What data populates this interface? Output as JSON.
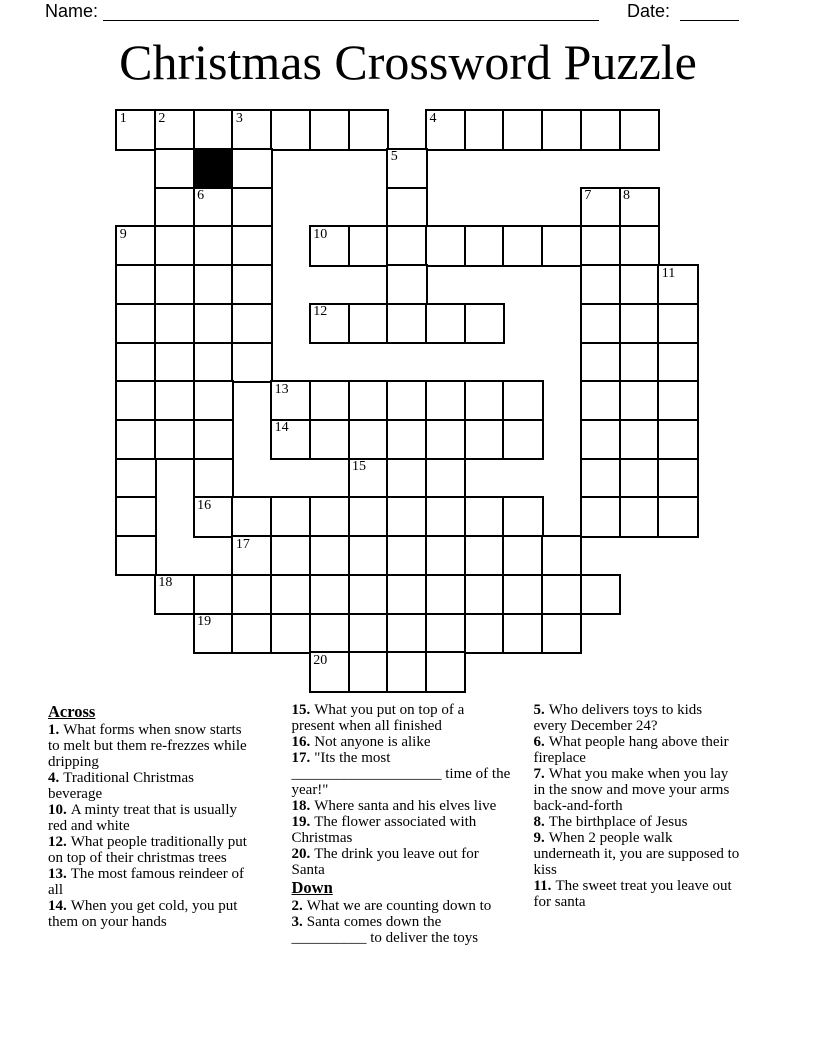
{
  "page": {
    "width": 816,
    "height": 1056,
    "background": "#ffffff"
  },
  "colors": {
    "ink": "#000000",
    "grid_line": "#000000",
    "block_cell": "#000000",
    "paper": "#ffffff"
  },
  "header": {
    "name_label": "Name:",
    "date_label": "Date:"
  },
  "title": "Christmas Crossword Puzzle",
  "grid": {
    "columns": 15,
    "rows": 15,
    "cells": [
      "OOOOOOO.OOOOOO.",
      ".O#O...O.......",
      ".OOO...O....OO.",
      "OOOO.OOOOOOOOO.",
      "OOOO...O....OOO",
      "OOOO.OOOOO..OOO",
      "OOOO........OOO",
      "OOO.OOOOOOO.OOO",
      "OOO.OOOOOOO.OOO",
      "O.O...OOO...OOO",
      "O.OOOOOOOOO.OOO",
      "O..OOOOOOOOO...",
      ".OOOOOOOOOOOO..",
      "..OOOOOOOOOO...",
      ".....OOOO......"
    ],
    "numbers": {
      "0,0": "1",
      "0,1": "2",
      "0,3": "3",
      "0,8": "4",
      "1,7": "5",
      "2,2": "6",
      "2,12": "7",
      "2,13": "8",
      "3,0": "9",
      "3,5": "10",
      "4,14": "11",
      "5,5": "12",
      "7,4": "13",
      "8,4": "14",
      "9,6": "15",
      "10,2": "16",
      "11,3": "17",
      "12,1": "18",
      "13,2": "19",
      "14,5": "20"
    }
  },
  "clues": {
    "columns": [
      {
        "items": [
          {
            "type": "heading",
            "text": "Across"
          },
          {
            "type": "clue",
            "num": "1.",
            "text": "What forms when snow starts\nto melt but them re-frezzes while\ndripping"
          },
          {
            "type": "clue",
            "num": "4.",
            "text": "Traditional Christmas\nbeverage"
          },
          {
            "type": "clue",
            "num": "10.",
            "text": "A minty treat that is usually\nred and white"
          },
          {
            "type": "clue",
            "num": "12.",
            "text": "What people traditionally put\non top of their christmas trees"
          },
          {
            "type": "clue",
            "num": "13.",
            "text": "The most famous reindeer of\nall"
          },
          {
            "type": "clue",
            "num": "14.",
            "text": "When you get cold, you put\nthem on your hands"
          }
        ]
      },
      {
        "items": [
          {
            "type": "clue",
            "num": "15.",
            "text": "What you put on top of a\npresent when all finished"
          },
          {
            "type": "clue",
            "num": "16.",
            "text": "Not anyone is alike"
          },
          {
            "type": "clue",
            "num": "17.",
            "text": "\"Its the most\n____________________ time of the\nyear!\""
          },
          {
            "type": "clue",
            "num": "18.",
            "text": "Where santa and his elves live"
          },
          {
            "type": "clue",
            "num": "19.",
            "text": "The flower associated with\nChristmas"
          },
          {
            "type": "clue",
            "num": "20.",
            "text": "The drink you leave out for\nSanta"
          },
          {
            "type": "heading",
            "text": "Down"
          },
          {
            "type": "clue",
            "num": "2.",
            "text": "What we are counting down to"
          },
          {
            "type": "clue",
            "num": "3.",
            "text": "Santa comes down the\n__________ to deliver the toys"
          }
        ]
      },
      {
        "items": [
          {
            "type": "clue",
            "num": "5.",
            "text": "Who delivers toys to kids\nevery December 24?"
          },
          {
            "type": "clue",
            "num": "6.",
            "text": "What people hang above their\nfireplace"
          },
          {
            "type": "clue",
            "num": "7.",
            "text": "What you make when you lay\nin the snow and move your arms\nback-and-forth"
          },
          {
            "type": "clue",
            "num": "8.",
            "text": "The birthplace of Jesus"
          },
          {
            "type": "clue",
            "num": "9.",
            "text": "When 2 people walk\nunderneath it, you are supposed to\nkiss"
          },
          {
            "type": "clue",
            "num": "11.",
            "text": "The sweet treat you leave out\nfor santa"
          }
        ]
      }
    ]
  }
}
